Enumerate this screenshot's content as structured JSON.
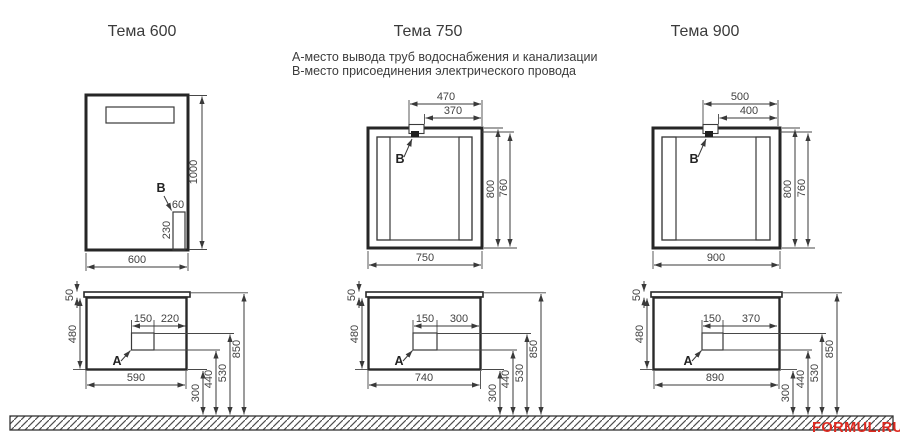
{
  "legend": {
    "line_a": "А-место вывода труб водоснабжения и канализации",
    "line_b": "В-место присоединения электрического провода"
  },
  "watermark": "FORMUL.RU",
  "panels": [
    {
      "title": "Тема 600",
      "mirror": {
        "height": "1000",
        "width": "600",
        "box_width": "60",
        "box_height": "230",
        "point": "В"
      },
      "vanity": {
        "counter": "50",
        "height": "480",
        "seg1": "150",
        "seg2": "220",
        "width": "590",
        "point": "А",
        "h300": "300",
        "h440": "440",
        "h530": "530",
        "h850": "850"
      }
    },
    {
      "title": "Тема 750",
      "mirror": {
        "off1": "470",
        "off2": "370",
        "height": "800",
        "inner": "760",
        "width": "750",
        "point": "В"
      },
      "vanity": {
        "counter": "50",
        "height": "480",
        "seg1": "150",
        "seg2": "300",
        "width": "740",
        "point": "А",
        "h300": "300",
        "h440": "440",
        "h530": "530",
        "h850": "850"
      }
    },
    {
      "title": "Тема 900",
      "mirror": {
        "off1": "500",
        "off2": "400",
        "height": "800",
        "inner": "760",
        "width": "900",
        "point": "В"
      },
      "vanity": {
        "counter": "50",
        "height": "480",
        "seg1": "150",
        "seg2": "370",
        "width": "890",
        "point": "А",
        "h300": "300",
        "h440": "440",
        "h530": "530",
        "h850": "850"
      }
    }
  ],
  "colors": {
    "line": "#3a3a3a",
    "watermark": "#dd2a20"
  }
}
